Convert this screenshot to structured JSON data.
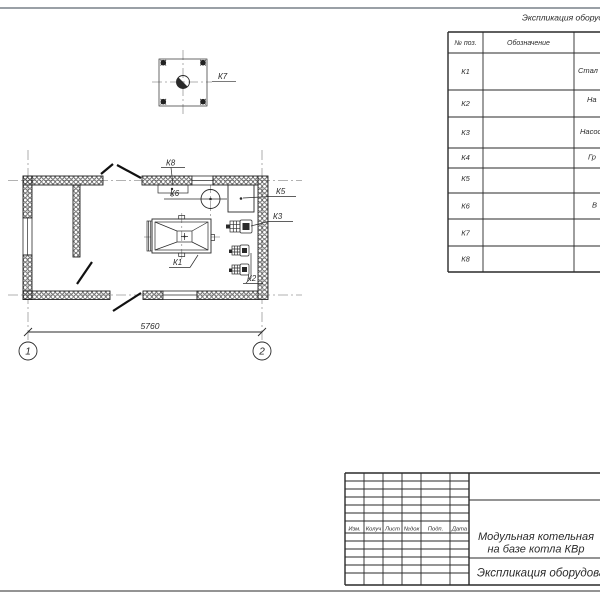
{
  "sheet": {
    "plan": {
      "labels": {
        "k1": "К1",
        "k2": "К2",
        "k3": "К3",
        "k5": "К5",
        "k6": "К6",
        "k7": "К7",
        "k8": "К8"
      },
      "dimension": "5760",
      "axis1": "1",
      "axis2": "2"
    },
    "equipment_table": {
      "title": "Экспликация оборуд",
      "header_pos": "№ поз.",
      "header_designation": "Обозначение",
      "rows": [
        {
          "pos": "К1",
          "name": "Стал"
        },
        {
          "pos": "К2",
          "name": "На"
        },
        {
          "pos": "К3",
          "name": "Насос"
        },
        {
          "pos": "К4",
          "name": "Гр"
        },
        {
          "pos": "К5",
          "name": ""
        },
        {
          "pos": "К6",
          "name": "В"
        },
        {
          "pos": "К7",
          "name": ""
        },
        {
          "pos": "К8",
          "name": ""
        }
      ]
    },
    "title_block": {
      "cols": {
        "izm": "Изм.",
        "kol": "Колуч",
        "list": "Лист",
        "ndoc": "№док",
        "podp": "Подп.",
        "data": "Дата"
      },
      "project_line1": "Модульная котельная",
      "project_line2": "на базе котла КВр",
      "doc_name": "Экспликация оборудован"
    }
  }
}
